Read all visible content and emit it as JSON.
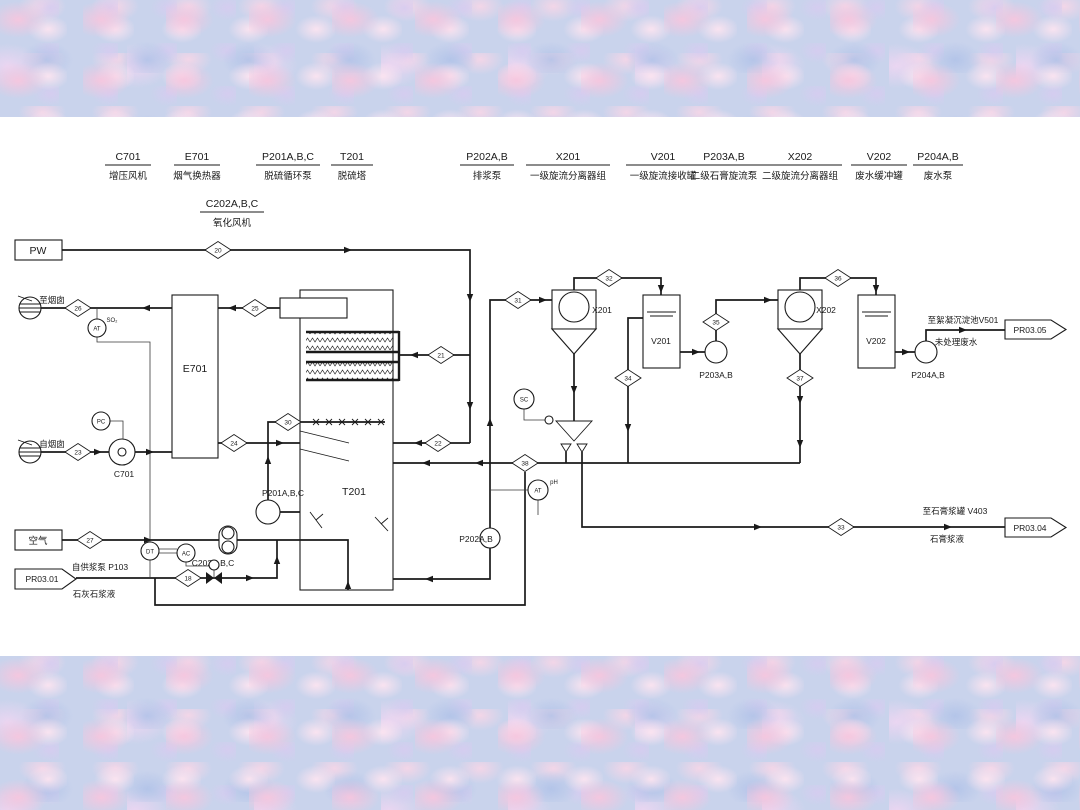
{
  "legend": {
    "i0": {
      "tag": "C701",
      "name": "增压风机"
    },
    "i1": {
      "tag": "E701",
      "name": "烟气换热器"
    },
    "i2": {
      "tag": "P201A,B,C",
      "name": "脱硫循环泵"
    },
    "i3": {
      "tag": "T201",
      "name": "脱硫塔"
    },
    "i4": {
      "tag": "C202A,B,C",
      "name": "氧化风机"
    },
    "i5": {
      "tag": "P202A,B",
      "name": "排浆泵"
    },
    "i6": {
      "tag": "X201",
      "name": "一级旋流分离器组"
    },
    "i7": {
      "tag": "V201",
      "name": "一级旋流接收罐"
    },
    "i8": {
      "tag": "P203A,B",
      "name": "二级石膏旋流泵"
    },
    "i9": {
      "tag": "X202",
      "name": "二级旋流分离器组"
    },
    "i10": {
      "tag": "V202",
      "name": "废水缓冲罐"
    },
    "i11": {
      "tag": "P204A,B",
      "name": "废水泵"
    }
  },
  "equipment": {
    "t201": "T201",
    "e701": "E701",
    "c701": "C701",
    "c202": "C202A,B,C",
    "p201": "P201A,B,C",
    "p202": "P202A,B",
    "p203": "P203A,B",
    "p204": "P204A,B",
    "x201": "X201",
    "x202": "X202",
    "v201": "V201",
    "v202": "V202"
  },
  "io": {
    "pw": "PW",
    "air": "空气",
    "pr0301": "PR03.01",
    "pr0304": "PR03.04",
    "pr0305": "PR03.05",
    "to_stack": "至烟囱",
    "from_stack": "自烟囱",
    "from_pump": "自供浆泵 P103",
    "limestone": "石灰石浆液",
    "to_floc": "至絮凝沉淀池V501",
    "untreated": "未处理废水",
    "to_gypsum_tank": "至石膏浆罐 V403",
    "gypsum_slurry": "石膏浆液"
  },
  "instruments": {
    "at": "AT",
    "so2": "SO₂",
    "pc": "PC",
    "dt": "DT",
    "ac": "AC",
    "sc": "SC",
    "ph": "pH"
  },
  "streams": {
    "s18": "18",
    "s20": "20",
    "s21": "21",
    "s22": "22",
    "s23": "23",
    "s24": "24",
    "s25": "25",
    "s26": "26",
    "s27": "27",
    "s30": "30",
    "s31": "31",
    "s32": "32",
    "s33": "33",
    "s34": "34",
    "s35": "35",
    "s36": "36",
    "s37": "37",
    "s38": "38"
  }
}
